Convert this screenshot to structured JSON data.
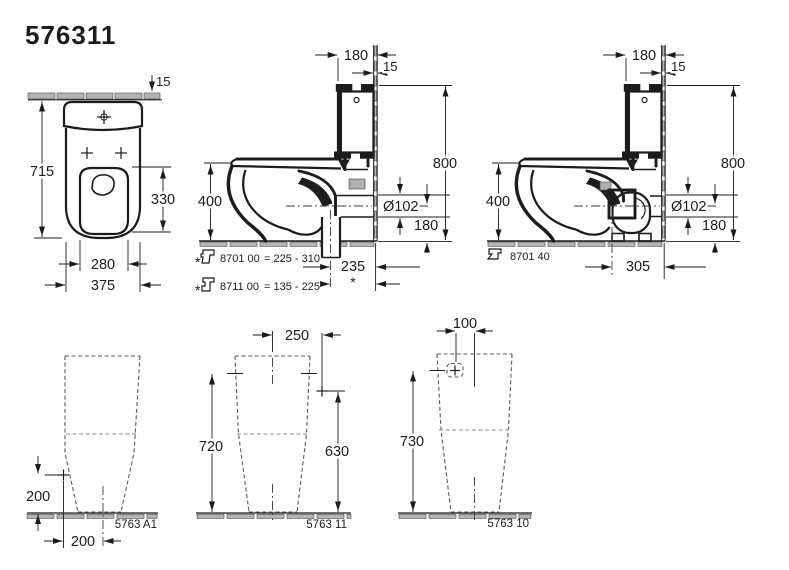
{
  "title": "576311",
  "colors": {
    "line": "#1c1c1c",
    "hatch_fill": "#b4b4b4",
    "dashed_outline": "#5a5a5a",
    "background": "#ffffff"
  },
  "plan_view": {
    "dim_wall_thickness": "15",
    "dim_depth": "715",
    "dim_seat_opening": "330",
    "dim_inner_width": "280",
    "dim_overall_width": "375"
  },
  "side_view_floor_outlet": {
    "dim_cistern_depth": "180",
    "dim_wall_thickness": "15",
    "dim_total_height": "800",
    "dim_rim_height": "400",
    "dim_outlet_diameter": "Ø102",
    "dim_outlet_center_height": "180",
    "dim_outlet_offset": "235",
    "outlet_offset_note": "*",
    "accessory_notes": [
      {
        "marker": "*",
        "code": "8701 00",
        "range": "= 225 - 310"
      },
      {
        "marker": "*",
        "code": "8711 00",
        "range": "= 135 - 225"
      }
    ]
  },
  "side_view_wall_outlet": {
    "dim_cistern_depth": "180",
    "dim_wall_thickness": "15",
    "dim_total_height": "800",
    "dim_rim_height": "400",
    "dim_outlet_diameter": "Ø102",
    "dim_outlet_center_height": "180",
    "dim_outlet_offset": "305",
    "accessory_notes": [
      {
        "code": "8701 40"
      }
    ]
  },
  "rear_views": [
    {
      "label": "5763 A1",
      "dim_marker_height": "200",
      "dim_marker_offset": "200"
    },
    {
      "label": "5763 11",
      "dim_top_offset": "250",
      "dim_height": "720",
      "dim_marker_height": "630"
    },
    {
      "label": "5763 10",
      "dim_top_offset": "100",
      "dim_marker_height": "730"
    }
  ]
}
